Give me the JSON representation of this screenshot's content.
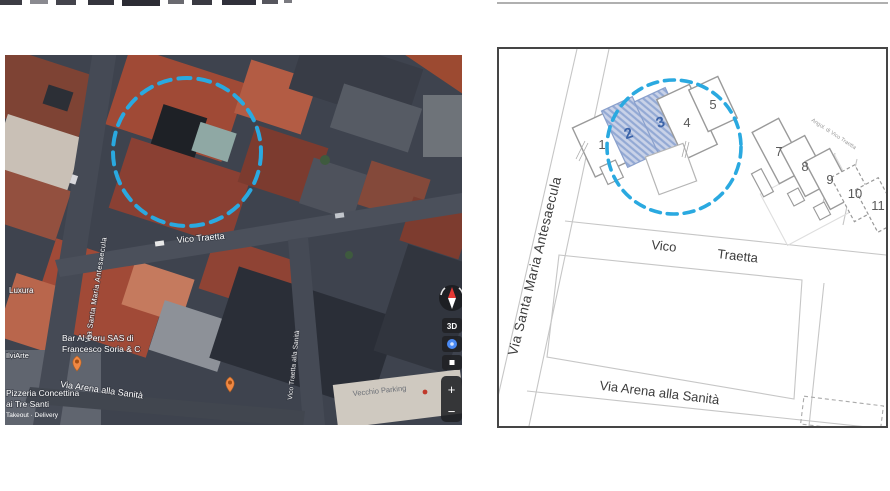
{
  "colors": {
    "accent_blue": "#2aa9e0",
    "pin_orange": "#ef8844",
    "hatch_fill": "#c9d2e8",
    "hatch_stripe": "#93a9d4"
  },
  "left_map": {
    "streets": {
      "antesaecula": "Via Santa Maria Antesaecula",
      "vico_traetta": "Vico Traetta",
      "vico_traetta_sanita": "Vico Traetta alla Sanità",
      "via_arena": "Via Arena alla Sanità"
    },
    "pois": {
      "luxura": "Luxura",
      "ilviarte": "IlviArte",
      "bar_line1": "Bar Al Peru SAS di",
      "bar_line2": "Francesco Soria & C",
      "pizzeria_line1": "Pizzeria Concettina",
      "pizzeria_line2": "ai Tre Santi",
      "pizzeria_sub": "Takeout · Delivery",
      "parking": "Vecchio Parking"
    },
    "controls": {
      "three_d": "3D",
      "zoom_in": "+",
      "zoom_out": "−"
    }
  },
  "right_map": {
    "streets": {
      "antesaecula": "Via Santa Maria Antesaecula",
      "vico": "Vico",
      "traetta": "Traetta",
      "via_arena": "Via Arena alla Sanità",
      "angol": "Angol. di Vico Traetta"
    },
    "buildings": [
      "1",
      "2",
      "3",
      "4",
      "5",
      "7",
      "8",
      "9",
      "10",
      "11"
    ]
  }
}
